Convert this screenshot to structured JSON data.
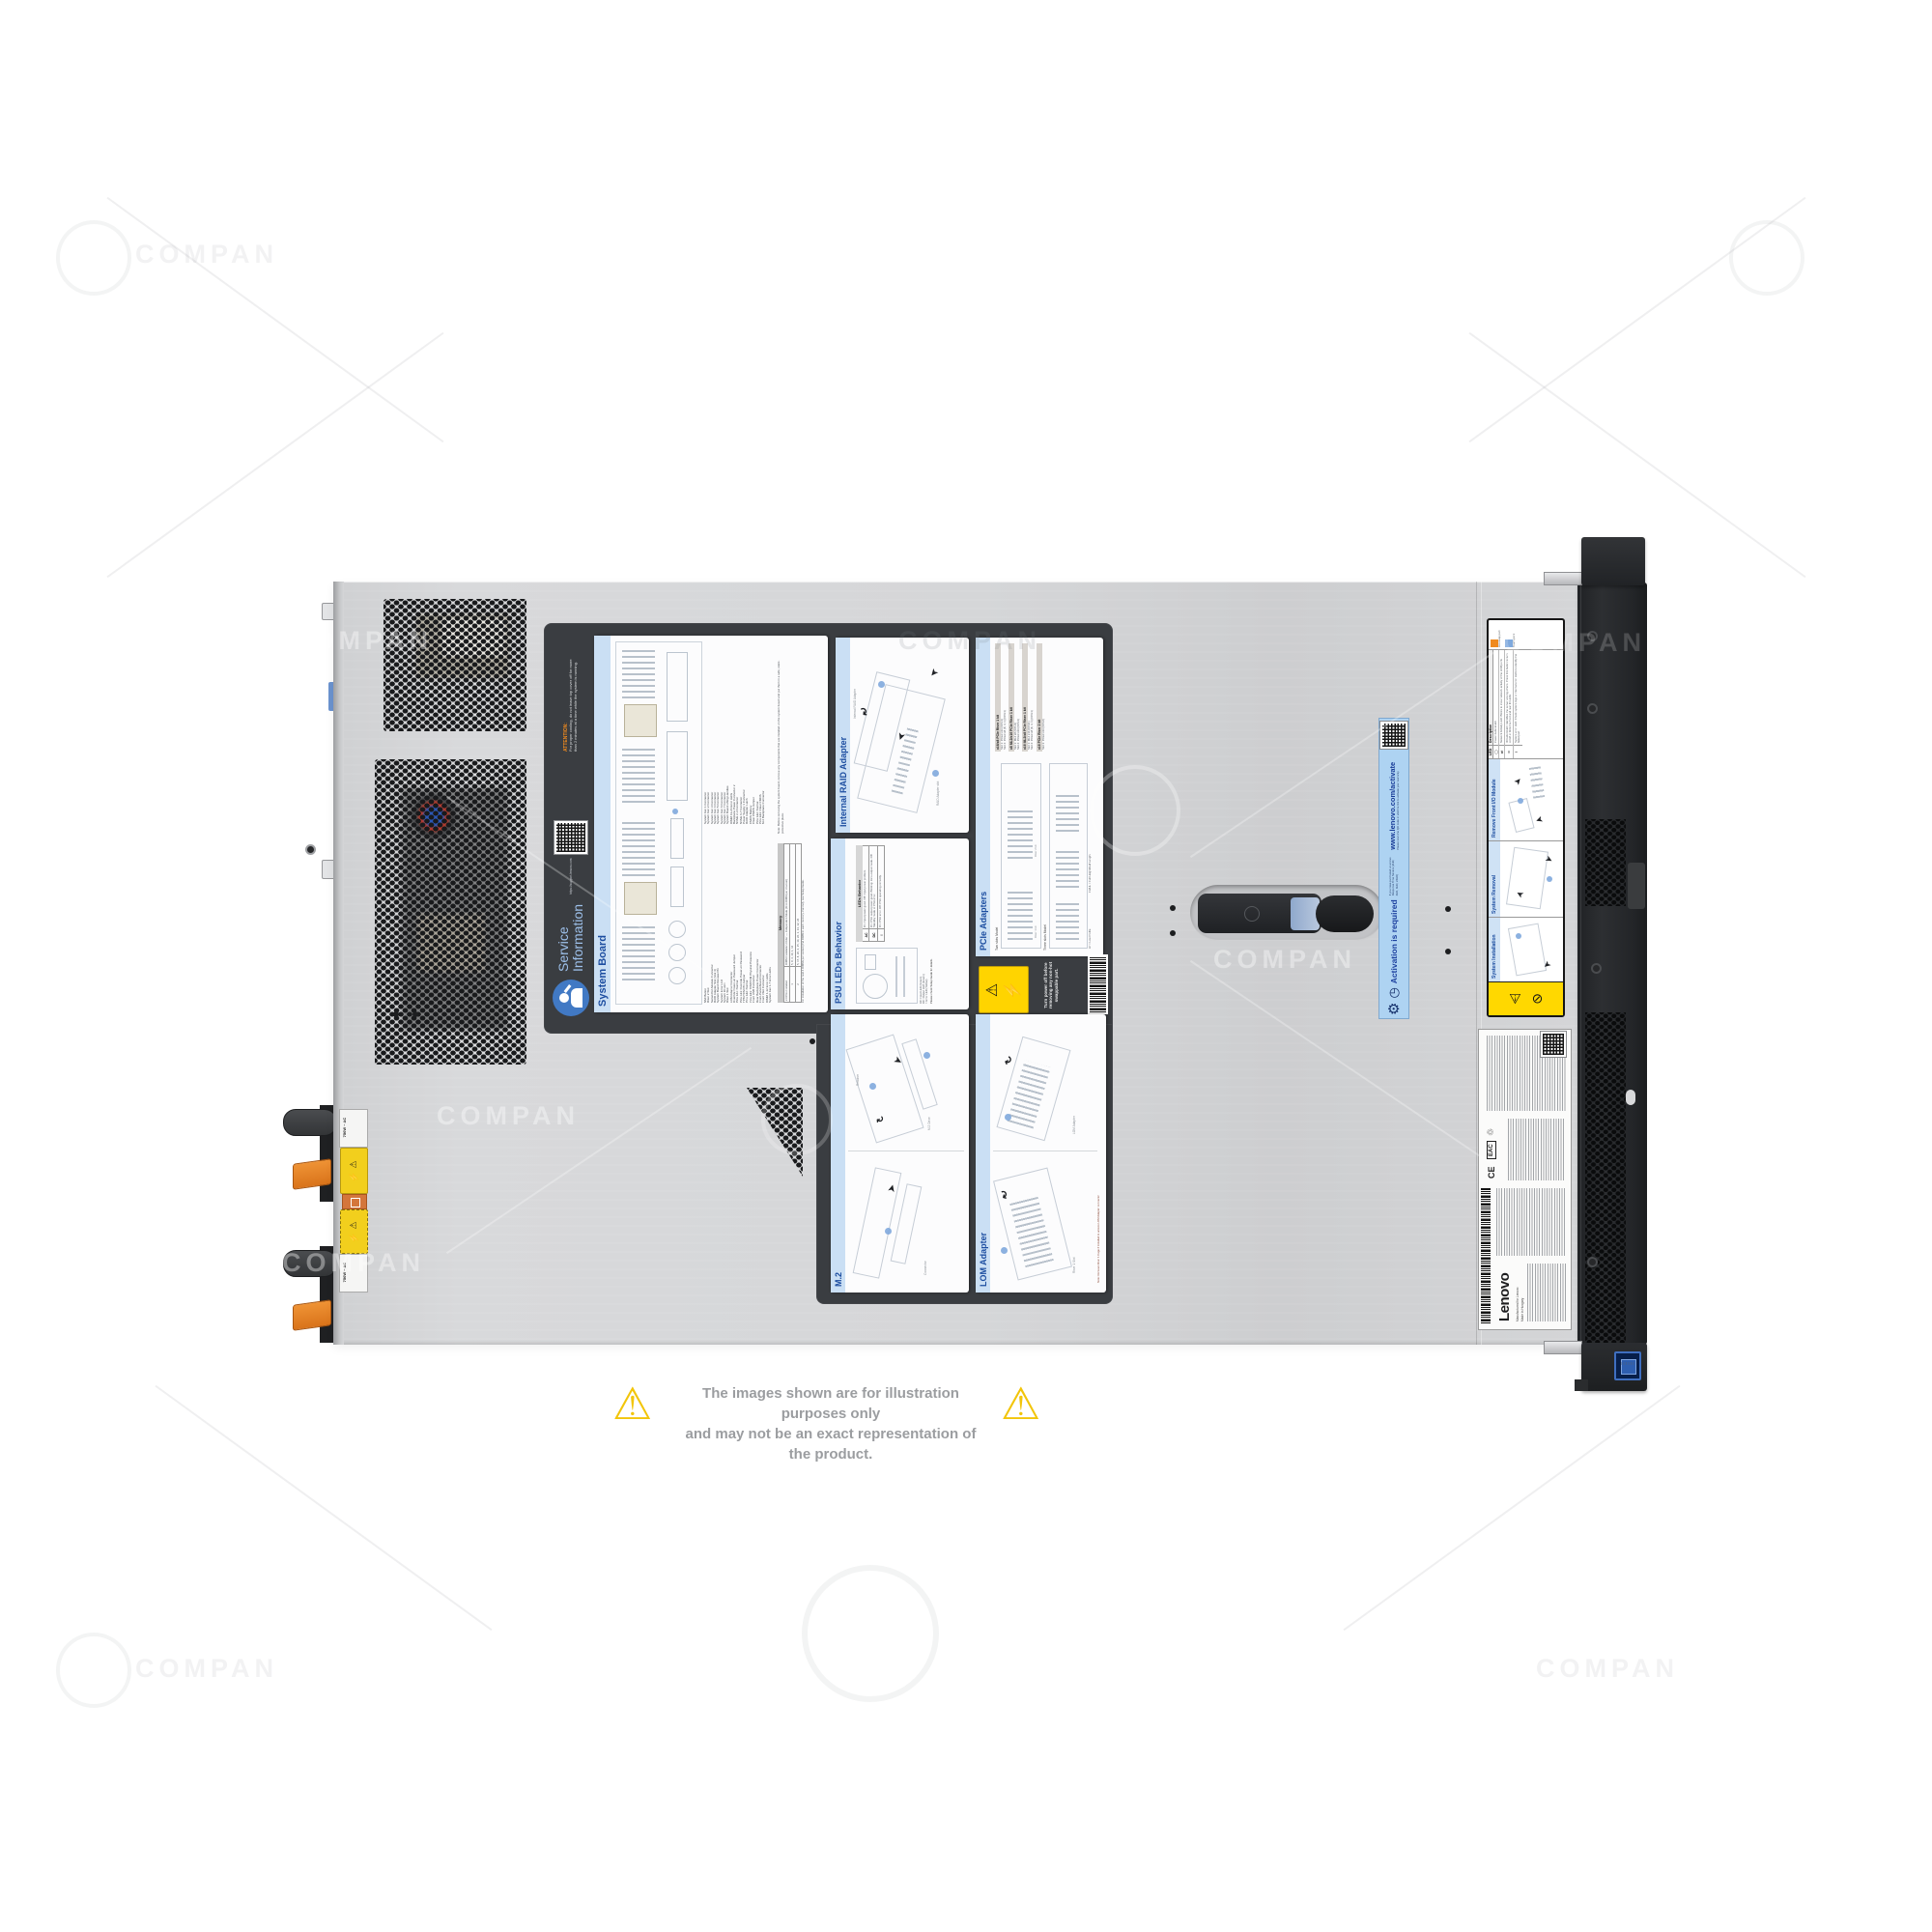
{
  "watermark": {
    "text": "COMPAN"
  },
  "icons": {
    "warning": "⚠",
    "high_voltage": "⚡",
    "no_touch": "⊘",
    "arrow": "➤",
    "arrow_curved": "↷",
    "clock": "◷",
    "gear": "⚙",
    "network_led": "⇄",
    "power_led": "◯",
    "id_led": "ID",
    "error_led": "!",
    "recycle": "♲"
  },
  "disclaimer": {
    "line1": "The images shown are for illustration purposes only",
    "line2": "and may not be an exact representation of the product."
  },
  "rear": {
    "psu1_rating": "750W ~ AC",
    "psu2_rating": "750W ~ AC"
  },
  "service_panel": {
    "title_line1": "Service",
    "title_line2": "Information",
    "qr_caption": "https://support.lenovo.com",
    "attention_title": "ATTENTION:",
    "attention_body": "For proper cooling, do not leave top cover off for more than 2 minutes at a time while the system is running."
  },
  "system_board_label": {
    "title": "System Board",
    "legend_left": [
      "NMI Button",
      "Riser 2 Slot",
      "Serial-Port-Module Connector",
      "RAID Adapter Slot (Slot 4)",
      "System Board Release Pin",
      "System Error LED",
      "System ID LED",
      "Riser 1 Slot",
      "LOM Adapter Connector",
      "Override Power-on Password Jumper",
      "Pins 1&2: Normal",
      "Pins 2&3: Override Power-on Password",
      "TPM/TCM PD Jumper",
      "Pins 1&2: Normal",
      "Pins 2&3: TPM/TCM Physical Presence",
      "Front USB Connector",
      "Rear Backplane Power Connector",
      "Front-Panel-Board Connector",
      "Front VGA Connector",
      "DIMM 1-12 Error LEDs",
      "System Fan 1-7 Error LEDs"
    ],
    "legend_right": [
      "System Fan 1 Connector",
      "System Fan 2 Connector",
      "System Fan 3 Connector",
      "System Fan 4 Connector",
      "System Fan 5 Connector",
      "System Fan 6 Connector",
      "System Fan 7 Connector",
      "System Board Lifting Handles",
      "DIMM 13-24 Error LEDs",
      "Backplane Power Connector 2",
      "NVMe 2-3 Connector",
      "NVMe 6-7 Connector",
      "Power Supply 1 Connector",
      "RAID Adapter Latch",
      "CMOS Battery",
      "Clear CMOS Jumper",
      "Pins 1&2: Normal",
      "Pins 2&3: Clear CMOS",
      "M.2 Backplane Connector"
    ],
    "note": "Note: Before removing the system board, remove any components that are installed on the system board and put them in a safe, static-protective place.",
    "memory_title": "Memory",
    "memory_col1": "# CPUs Installed",
    "memory_col2": "DIMM Installation Order — Independent Mode (First DIMM per channel)",
    "memory_r1c1": "1",
    "memory_r1c2": "5, 8, 3, 10, 1, 12",
    "memory_r2c1": "2",
    "memory_r2c2": "5, 17, 8, 20, 3, 15, 10, 22, 1, 13, 12, 24",
    "memory_note": "For installation of the next 6 DIMMs per socket (2nd DIMM in each memory channel), see Setup Guide."
  },
  "raid_label": {
    "title": "Internal RAID Adapter",
    "caption1": "RAID Adapter slot",
    "caption2": "Internal RAID Adapter"
  },
  "psu_label": {
    "title": "PSU LEDs Behavior",
    "legend1": "AC: Input LED (Green)",
    "legend2": "DC: Output LED (Green)",
    "legend3": "!: Error LED (Yellow)",
    "note": "Please check Setup Guide for details.",
    "table_title": "LEDs Behavior",
    "rows": [
      {
        "led": "AC",
        "desc": "On: Input power good. Off: Input power problem."
      },
      {
        "led": "DC",
        "desc": "On: PSU output power good. Blinking: Zero-output mode. Off: Standby mode or PSU error."
      },
      {
        "led": "!",
        "desc": "On: PSU error. Off: PSU operating correctly."
      }
    ]
  },
  "pcie_label": {
    "title": "PCIe Adapters",
    "caption_two": "Two slots Model",
    "caption_three": "Three slots Model",
    "caption_r1": "Riser 1 kit",
    "caption_r2": "Riser 2 kit",
    "kits": [
      {
        "name": "x16/x8 PCIe Riser 1 kit",
        "slot1": "Slot 1: PCIe3 x16 (CPU1)",
        "slot2": "Slot 2: PCIe3 x8 (8, 4, 1) (CPU1)"
      },
      {
        "name": "x8 ML2/x16 PCIe Riser 1 kit",
        "slot1": "Slot 1: ML2 x8 (CPU1)",
        "slot2": "Slot 2: PCIe3 x16 (CPU1)"
      },
      {
        "name": "x16 ML2/x8 PCIe Riser 1 kit",
        "slot1": "Slot 1: ML2 x16 (CPU1)",
        "slot2": "Slot 2: PCIe3 x8 (8, 4, 1) (CPU1)"
      },
      {
        "name": "x16 PCIe Riser 2 kit",
        "slot1": "Slot 3: PCIe3 x16 (CPU2)",
        "slot2": ""
      }
    ],
    "footnote1": "LP = Low Profile",
    "footnote2": "FH/HL = Full Height/Half Length"
  },
  "m2_label": {
    "title": "M.2",
    "cap1": "M.2 Drive",
    "cap2": "Retainer",
    "cap3": "Connector"
  },
  "lom_label": {
    "title": "LOM Adapter",
    "cap1": "LOM Adapter",
    "cap2": "Riser 1 Slot",
    "note": "Note: Remove Riser 1 Cage if installed to access LOM Adapter connector"
  },
  "power_off_label": {
    "text": "Turn power off before removing any non-hot swappable part."
  },
  "activation_label": {
    "title": "Activation is required",
    "body1": "If you have purchased a Lenovo Response Time Service (2HR, 4HR, 6HR, 24HR)",
    "body2": "Please scan the QR code or visit the link to activate your warranty",
    "url": "www.lenovo.com/activate"
  },
  "front_io_label": {
    "section_install": "System Installation",
    "section_removal": "System Removal",
    "section_remove_io": "Remove Front I/O Module",
    "led_col1": "LED",
    "led_col2": "Description",
    "led_rows": [
      "Power button/LED",
      "Network Activity LED: Blinks to show network activity of the LOM ports",
      "ID button/LED: Identifies the server among others. Press this button to turn on/off or blink the front and rear ID LEDs",
      "System error LED: Check system logs or internal error LEDs to identify the failed part"
    ],
    "hot_swap": "Hot-swap part",
    "touch_point": "Touch point"
  },
  "regulatory_label": {
    "brand": "Lenovo",
    "mfg1": "Manufactured for Lenovo",
    "mfg2": "Made in Hungary",
    "ce": "CE",
    "eac": "EAC"
  }
}
